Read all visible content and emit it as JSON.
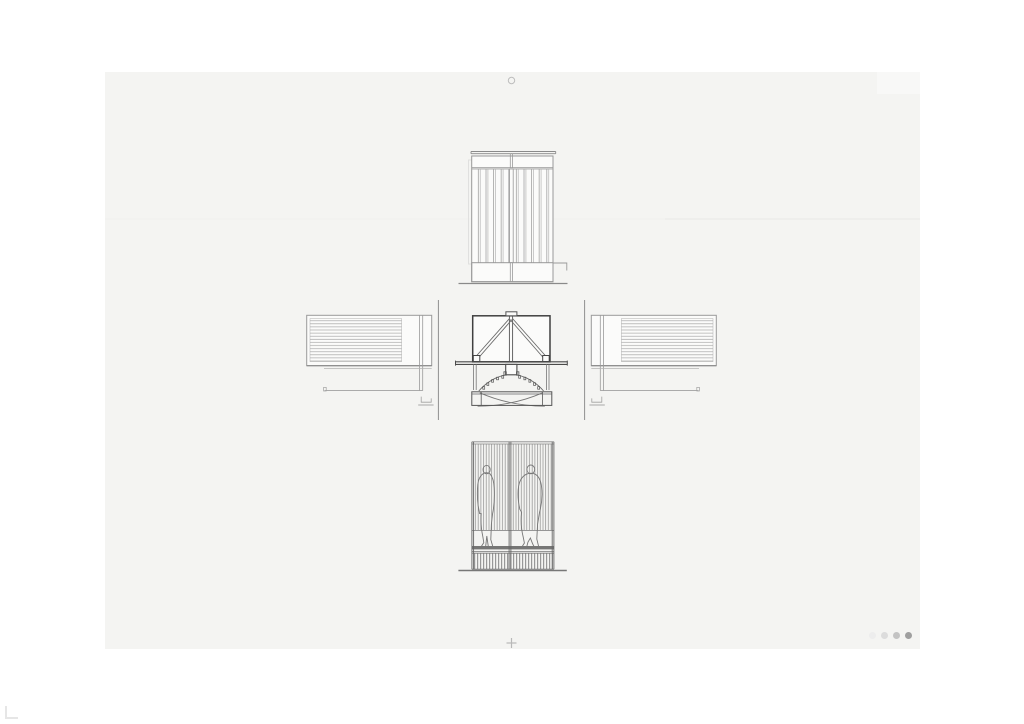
{
  "viewer": {
    "background_color": "#ffffff",
    "sheet_color": "#f4f4f2",
    "line_color_light": "#9a9a9a",
    "line_color_dark": "#3f3f3f",
    "fold_line_color": "#e9e9e9"
  },
  "sheet": {
    "drawings": [
      {
        "id": "top-elevation",
        "name": "front elevation with vertical slats"
      },
      {
        "id": "left-elevation",
        "name": "left side elevation with horizontal louvers"
      },
      {
        "id": "center-section",
        "name": "central section with truss frame and curved swing leaves"
      },
      {
        "id": "right-elevation",
        "name": "right side elevation with horizontal louvers"
      },
      {
        "id": "bottom-elevation",
        "name": "rear elevation with slatted screen and two human figures"
      }
    ],
    "marks": {
      "registration_circle": "small circle at top center of sheet",
      "crop_cross": "small plus mark at bottom center of sheet",
      "corner_crop": "L-shaped crop mark at bottom-left of canvas"
    }
  },
  "pagination": {
    "dots": [
      {
        "color": "#ededed"
      },
      {
        "color": "#dcdcdc"
      },
      {
        "color": "#c3c3c3"
      },
      {
        "color": "#9f9f9f"
      }
    ]
  }
}
